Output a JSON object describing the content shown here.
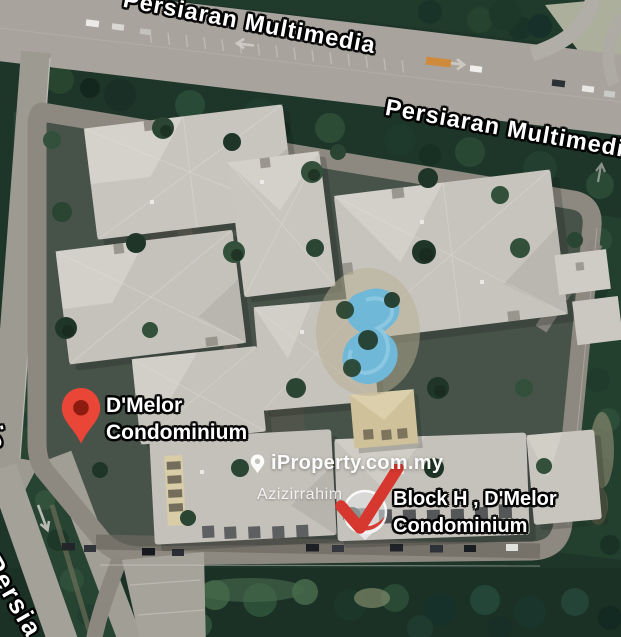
{
  "road_labels": {
    "multimedia_upper": "Persiaran Multimedia",
    "multimedia_lower": "Persiaran Multimedia",
    "ceria": "n Ceria",
    "persiaran_partial": "Persia"
  },
  "markers": {
    "dmelor": {
      "line1": "D'Melor",
      "line2": "Condominium"
    },
    "block_h": {
      "line1": "Block H , D'Melor",
      "line2": "Condominium"
    }
  },
  "watermark": {
    "brand": "iProperty.com.my",
    "agent": "Azizirrahim"
  },
  "icons": {
    "dmelor_pin": "map-pin",
    "block_h_marker": "check-pin",
    "watermark_pin": "location-pin",
    "road_arrow": "direction-arrow"
  },
  "colors": {
    "pin_red": "#e94638",
    "pin_inner_red": "#8e1b10",
    "check_red": "#d6372e",
    "pool_blue": "#6fb8d8",
    "road_gray": "#a8a49d",
    "forest_green": "#1d3428",
    "label_white": "#ffffff"
  }
}
